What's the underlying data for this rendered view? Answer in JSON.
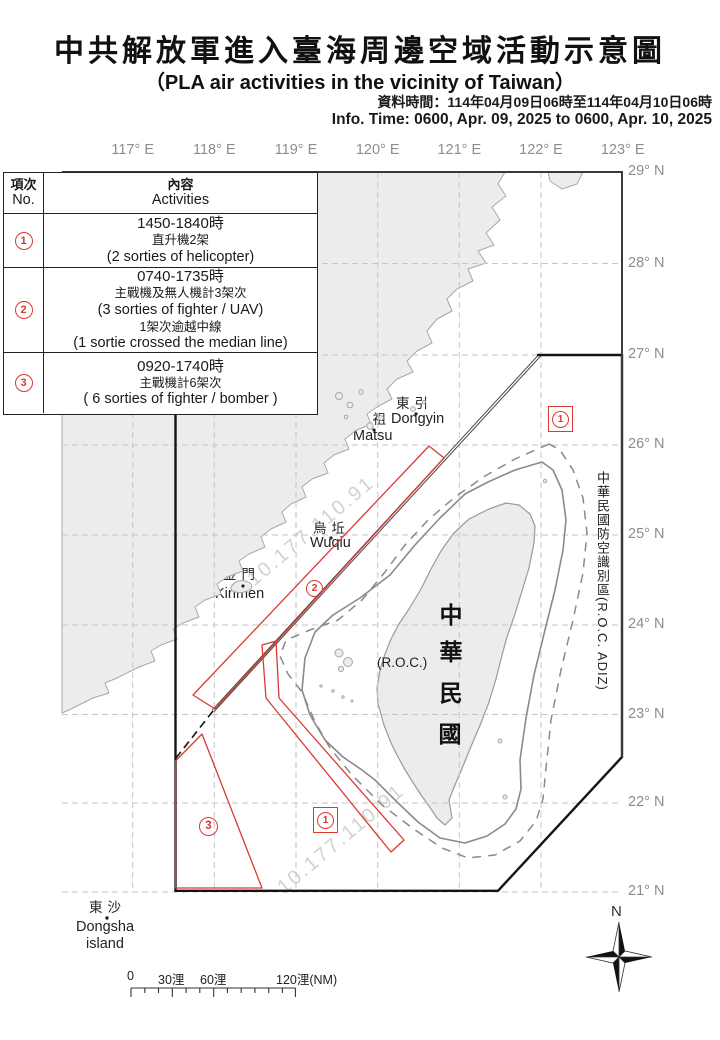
{
  "header": {
    "title": "中共解放軍進入臺海周邊空域活動示意圖",
    "subtitle": "（PLA air activities in the vicinity of Taiwan）",
    "info_zh": "資料時間：114年04月09日06時至114年04月10日06時",
    "info_en": "Info. Time: 0600, Apr. 09, 2025 to 0600, Apr. 10, 2025"
  },
  "table": {
    "col_no_zh": "項次",
    "col_no_en": "No.",
    "col_act_zh": "內容",
    "col_act_en": "Activities",
    "rows": [
      {
        "num": "1",
        "lines": [
          "1450-1840時",
          "直升機2架",
          "(2 sorties of helicopter)"
        ]
      },
      {
        "num": "2",
        "lines": [
          "0740-1735時",
          "主戰機及無人機計3架次",
          "(3 sorties of fighter / UAV)",
          "1架次逾越中線",
          "(1 sortie crossed the median line)"
        ]
      },
      {
        "num": "3",
        "lines": [
          "0920-1740時",
          "主戰機計6架次",
          "( 6 sorties of fighter / bomber )"
        ]
      }
    ]
  },
  "map": {
    "lon_labels": [
      "117° E",
      "118° E",
      "119° E",
      "120° E",
      "121° E",
      "122° E",
      "123° E"
    ],
    "lat_labels": [
      "29° N",
      "28° N",
      "27° N",
      "26° N",
      "25° N",
      "24° N",
      "23° N",
      "22° N",
      "21° N"
    ],
    "adiz_label": "中華民國防空識別區(R.O.C. ADIZ)",
    "island": {
      "chars": [
        "中",
        "華",
        "民",
        "國"
      ],
      "roc": "(R.O.C.)"
    },
    "places": {
      "dongyin_zh": "東引",
      "dongyin_en": "Dongyin",
      "matsu_zh": "馬祖",
      "matsu_en": "Matsu",
      "wuqiu_zh": "烏坵",
      "wuqiu_en": "Wuqiu",
      "kinmen_zh": "金門",
      "kinmen_en": "Kinmen",
      "dongsha_zh": "東沙",
      "dongsha_en_1": "Dongsha",
      "dongsha_en_2": "island"
    },
    "markers": {
      "one": "1",
      "two": "2",
      "three": "3"
    },
    "compass_n": "N",
    "scale": {
      "l0": "0",
      "l30": "30浬",
      "l60": "60浬",
      "l120": "120浬(NM)"
    },
    "watermark": "10.177.110.91",
    "colors": {
      "red": "#d93a32",
      "adiz": "#141414",
      "grid": "#c6c6c6",
      "land": "#ececec",
      "coast": "#a8a8a8",
      "label_gray": "#8d8d8d"
    }
  }
}
